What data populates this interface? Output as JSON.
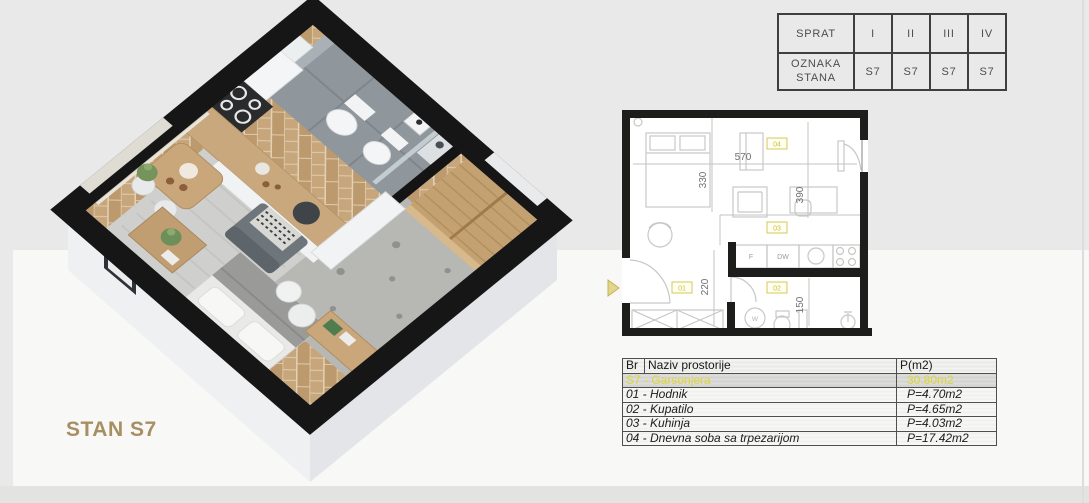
{
  "title": "STAN S7",
  "floor_table": {
    "sprat_label": "SPRAT",
    "oznaka_label": "OZNAKA STANA",
    "floors": [
      "I",
      "II",
      "III",
      "IV"
    ],
    "units": [
      "S7",
      "S7",
      "S7",
      "S7"
    ]
  },
  "plan_2d": {
    "dims": {
      "top": "570",
      "left_upper": "330",
      "right_upper": "390",
      "left_lower": "220",
      "right_lower": "150"
    },
    "rooms": {
      "hallway": "01",
      "bathroom": "02",
      "kitchen": "03",
      "living": "04"
    },
    "appliances": {
      "fridge": "F",
      "dishwasher": "DW",
      "washer": "W"
    }
  },
  "area_table": {
    "headers": {
      "br": "Br",
      "name": "Naziv prostorije",
      "area": "P(m2)"
    },
    "summary": {
      "name": "S7 - Garsonjera",
      "area": "30.80m2"
    },
    "rows": [
      {
        "name": "01 - Hodnik",
        "area": "P=4.70m2"
      },
      {
        "name": "02 - Kupatilo",
        "area": "P=4.65m2"
      },
      {
        "name": "03 - Kuhinja",
        "area": "P=4.03m2"
      },
      {
        "name": "04 - Dnevna soba sa trpezarijom",
        "area": "P=17.42m2"
      }
    ]
  },
  "colors": {
    "accent_yellow": "#ddd637",
    "title_gold": "#a78f63",
    "wall_black": "#161616",
    "wood": "#c8a67c"
  }
}
